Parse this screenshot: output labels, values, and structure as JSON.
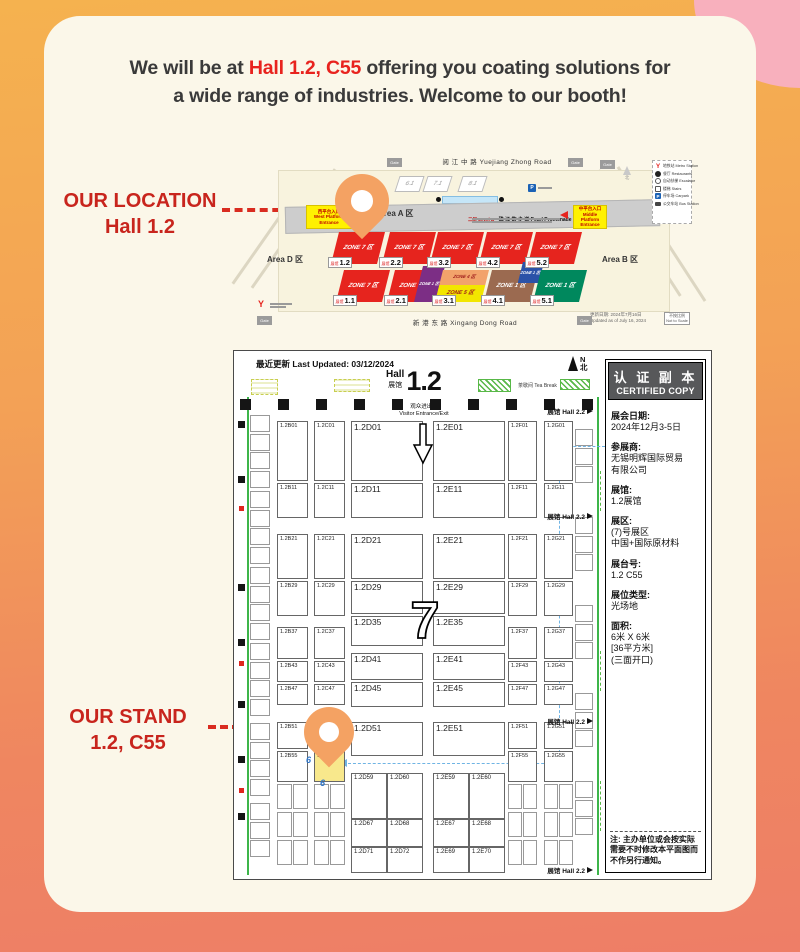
{
  "colors": {
    "accent_red": "#E8231E",
    "callout_red": "#C8251D",
    "pin_orange": "#F4A263",
    "stand_highlight": "#F8E88C",
    "zone7_red": "#E6241E"
  },
  "headline": {
    "line1_pre": "We will be at ",
    "line1_highlight": "Hall 1.2, C55",
    "line1_post": " offering you coating solutions for",
    "line2": "a wide range of industries. Welcome to our booth!"
  },
  "callouts": {
    "location_title": "OUR LOCATION",
    "location_value": "Hall 1.2",
    "stand_title": "OUR STAND",
    "stand_value": "1.2, C55"
  },
  "overview_map": {
    "roads": {
      "top": "阅 江 中 路  Yuejiang Zhong Road",
      "bottom": "新 港 东 路  Xingang Dong Road"
    },
    "gate_label": "Gate",
    "areas": {
      "a": "Area A 区",
      "b": "Area B 区",
      "d": "Area D 区"
    },
    "promenade": {
      "level": "二层 Level B",
      "name": "珠 江 散 步 道 Pearl Promenade"
    },
    "entrances": {
      "west": "西平台入口\nWest Platform\nEntrance",
      "middle": "中平台入口\nMiddle Platform\nEntrance"
    },
    "buildings": [
      "6.1",
      "7.1",
      "8.1"
    ],
    "north_label": "北",
    "parking_label": "P",
    "metro_label": "Y",
    "legend": [
      {
        "icon": "metro",
        "cn": "地铁站",
        "en": "Metro Station"
      },
      {
        "icon": "restaurant",
        "cn": "餐厅",
        "en": "Restaurants"
      },
      {
        "icon": "escalator",
        "cn": "自动扶梯",
        "en": "Escalator"
      },
      {
        "icon": "stairs",
        "cn": "楼梯",
        "en": "Stairs"
      },
      {
        "icon": "parking",
        "cn": "停车场",
        "en": "Carpark"
      },
      {
        "icon": "bus",
        "cn": "公交车站",
        "en": "Bus Station"
      }
    ],
    "update_note": "更新日期: 2024年7月16日\nUpdated as of July 16, 2024",
    "scale_note": "不按比例\nNot to Scale",
    "hall_chip_prefix": "展馆",
    "halls_row1": [
      {
        "id": "1.2",
        "parts": [
          {
            "pos": "full",
            "bg": "#E6241E",
            "tc": "#FFFFFF",
            "text": "ZONE 7 区"
          }
        ]
      },
      {
        "id": "2.2",
        "parts": [
          {
            "pos": "full",
            "bg": "#E6241E",
            "tc": "#FFFFFF",
            "text": "ZONE 7 区"
          }
        ]
      },
      {
        "id": "3.2",
        "parts": [
          {
            "pos": "full",
            "bg": "#E6241E",
            "tc": "#FFFFFF",
            "text": "ZONE 7 区"
          }
        ]
      },
      {
        "id": "4.2",
        "parts": [
          {
            "pos": "full",
            "bg": "#E6241E",
            "tc": "#FFFFFF",
            "text": "ZONE 7 区"
          }
        ]
      },
      {
        "id": "5.2",
        "parts": [
          {
            "pos": "full",
            "bg": "#E6241E",
            "tc": "#FFFFFF",
            "text": "ZONE 7 区"
          }
        ]
      }
    ],
    "halls_row2": [
      {
        "id": "1.1",
        "parts": [
          {
            "pos": "full",
            "bg": "#E6241E",
            "tc": "#FFFFFF",
            "text": "ZONE 7 区"
          }
        ]
      },
      {
        "id": "2.1",
        "parts": [
          {
            "pos": "full",
            "bg": "#E6241E",
            "tc": "#FFFFFF",
            "text": "ZONE 7 区"
          },
          {
            "pos": "right",
            "bg": "#7C2E85",
            "tc": "#FFFFFF",
            "text": "ZONE 1 区"
          }
        ]
      },
      {
        "id": "3.1",
        "parts": [
          {
            "pos": "top",
            "bg": "#F2A36B",
            "tc": "#9E1B1B",
            "text": "ZONE 4 区"
          },
          {
            "pos": "bottom",
            "bg": "#F2E600",
            "tc": "#9E1B1B",
            "text": "ZONE 5 区"
          }
        ]
      },
      {
        "id": "4.1",
        "parts": [
          {
            "pos": "full",
            "bg": "#9B6A50",
            "tc": "#FFFFFF",
            "text": "ZONE 1 区"
          },
          {
            "pos": "tr",
            "bg": "#2B52A8",
            "tc": "#FFFFFF",
            "text": "ZONE 1 区"
          }
        ]
      },
      {
        "id": "5.1",
        "parts": [
          {
            "pos": "full",
            "bg": "#00885D",
            "tc": "#FFFFFF",
            "text": "ZONE 1 区"
          }
        ]
      }
    ]
  },
  "floor_plan": {
    "last_updated": "最近更新 Last Updated: 03/12/2024",
    "title": {
      "en": "Hall",
      "cn": "展馆",
      "num": "1.2"
    },
    "compass": {
      "n": "N",
      "cn": "北"
    },
    "visitor_entrance": "观众进出口\nVisitor Entrance/Exit",
    "tea_break": "茶歇间 Tea Break",
    "hall22": "展馆 Hall 2.2",
    "zone_number": "7",
    "stand_number": "6",
    "booths": [
      {
        "i": "1.2B01",
        "x": 43,
        "y": 70,
        "w": 31,
        "h": 60,
        "f": 5.5
      },
      {
        "i": "1.2B11",
        "x": 43,
        "y": 132,
        "w": 31,
        "h": 35,
        "f": 5.5
      },
      {
        "i": "1.2B21",
        "x": 43,
        "y": 183,
        "w": 31,
        "h": 45,
        "f": 5.5
      },
      {
        "i": "1.2B29",
        "x": 43,
        "y": 230,
        "w": 31,
        "h": 35,
        "f": 5.5
      },
      {
        "i": "1.2B37",
        "x": 43,
        "y": 276,
        "w": 31,
        "h": 32,
        "f": 5.5
      },
      {
        "i": "1.2B43",
        "x": 43,
        "y": 310,
        "w": 31,
        "h": 21,
        "f": 5.5
      },
      {
        "i": "1.2B47",
        "x": 43,
        "y": 333,
        "w": 31,
        "h": 21,
        "f": 5.5
      },
      {
        "i": "1.2B51",
        "x": 43,
        "y": 371,
        "w": 31,
        "h": 27,
        "f": 5.5
      },
      {
        "i": "1.2B55",
        "x": 43,
        "y": 400,
        "w": 31,
        "h": 31,
        "f": 5.5
      },
      {
        "i": "1.2C01",
        "x": 80,
        "y": 70,
        "w": 31,
        "h": 60,
        "f": 5.5
      },
      {
        "i": "1.2C11",
        "x": 80,
        "y": 132,
        "w": 31,
        "h": 35,
        "f": 5.5
      },
      {
        "i": "1.2C21",
        "x": 80,
        "y": 183,
        "w": 31,
        "h": 45,
        "f": 5.5
      },
      {
        "i": "1.2C29",
        "x": 80,
        "y": 230,
        "w": 31,
        "h": 35,
        "f": 5.5
      },
      {
        "i": "1.2C37",
        "x": 80,
        "y": 276,
        "w": 31,
        "h": 32,
        "f": 5.5
      },
      {
        "i": "1.2C43",
        "x": 80,
        "y": 310,
        "w": 31,
        "h": 21,
        "f": 5.5
      },
      {
        "i": "1.2C47",
        "x": 80,
        "y": 333,
        "w": 31,
        "h": 21,
        "f": 5.5
      },
      {
        "i": "1.2C51",
        "x": 80,
        "y": 371,
        "w": 31,
        "h": 27,
        "f": 5.5
      },
      {
        "i": "1.2C55",
        "x": 80,
        "y": 400,
        "w": 31,
        "h": 31,
        "f": 5.5,
        "hl": 1
      },
      {
        "i": "1.2D01",
        "x": 117,
        "y": 70,
        "w": 72,
        "h": 60,
        "f": 8.5
      },
      {
        "i": "1.2D11",
        "x": 117,
        "y": 132,
        "w": 72,
        "h": 35,
        "f": 8.5
      },
      {
        "i": "1.2D21",
        "x": 117,
        "y": 183,
        "w": 72,
        "h": 45,
        "f": 8.5
      },
      {
        "i": "1.2D29",
        "x": 117,
        "y": 230,
        "w": 72,
        "h": 33,
        "f": 8.5
      },
      {
        "i": "1.2D35",
        "x": 117,
        "y": 265,
        "w": 72,
        "h": 30,
        "f": 8.5
      },
      {
        "i": "1.2D41",
        "x": 117,
        "y": 302,
        "w": 72,
        "h": 27,
        "f": 8.5
      },
      {
        "i": "1.2D45",
        "x": 117,
        "y": 331,
        "w": 72,
        "h": 25,
        "f": 8.5
      },
      {
        "i": "1.2D51",
        "x": 117,
        "y": 371,
        "w": 72,
        "h": 34,
        "f": 8.5
      },
      {
        "i": "1.2D59",
        "x": 117,
        "y": 422,
        "w": 36,
        "h": 46,
        "f": 6
      },
      {
        "i": "1.2D60",
        "x": 153,
        "y": 422,
        "w": 36,
        "h": 46,
        "f": 6
      },
      {
        "i": "1.2D67",
        "x": 117,
        "y": 468,
        "w": 36,
        "h": 28,
        "f": 6
      },
      {
        "i": "1.2D68",
        "x": 153,
        "y": 468,
        "w": 36,
        "h": 28,
        "f": 6
      },
      {
        "i": "1.2D71",
        "x": 117,
        "y": 496,
        "w": 36,
        "h": 26,
        "f": 6
      },
      {
        "i": "1.2D72",
        "x": 153,
        "y": 496,
        "w": 36,
        "h": 26,
        "f": 6
      },
      {
        "i": "1.2E01",
        "x": 199,
        "y": 70,
        "w": 72,
        "h": 60,
        "f": 8.5
      },
      {
        "i": "1.2E11",
        "x": 199,
        "y": 132,
        "w": 72,
        "h": 35,
        "f": 8.5
      },
      {
        "i": "1.2E21",
        "x": 199,
        "y": 183,
        "w": 72,
        "h": 45,
        "f": 8.5
      },
      {
        "i": "1.2E29",
        "x": 199,
        "y": 230,
        "w": 72,
        "h": 33,
        "f": 8.5
      },
      {
        "i": "1.2E35",
        "x": 199,
        "y": 265,
        "w": 72,
        "h": 30,
        "f": 8.5
      },
      {
        "i": "1.2E41",
        "x": 199,
        "y": 302,
        "w": 72,
        "h": 27,
        "f": 8.5
      },
      {
        "i": "1.2E45",
        "x": 199,
        "y": 331,
        "w": 72,
        "h": 25,
        "f": 8.5
      },
      {
        "i": "1.2E51",
        "x": 199,
        "y": 371,
        "w": 72,
        "h": 34,
        "f": 8.5
      },
      {
        "i": "1.2E59",
        "x": 199,
        "y": 422,
        "w": 36,
        "h": 46,
        "f": 6
      },
      {
        "i": "1.2E60",
        "x": 235,
        "y": 422,
        "w": 36,
        "h": 46,
        "f": 6
      },
      {
        "i": "1.2E67",
        "x": 199,
        "y": 468,
        "w": 36,
        "h": 28,
        "f": 6
      },
      {
        "i": "1.2E68",
        "x": 235,
        "y": 468,
        "w": 36,
        "h": 28,
        "f": 6
      },
      {
        "i": "1.2E69",
        "x": 199,
        "y": 496,
        "w": 36,
        "h": 26,
        "f": 6
      },
      {
        "i": "1.2E70",
        "x": 235,
        "y": 496,
        "w": 36,
        "h": 26,
        "f": 6
      },
      {
        "i": "1.2F01",
        "x": 274,
        "y": 70,
        "w": 29,
        "h": 60,
        "f": 5.5
      },
      {
        "i": "1.2F11",
        "x": 274,
        "y": 132,
        "w": 29,
        "h": 35,
        "f": 5.5
      },
      {
        "i": "1.2F21",
        "x": 274,
        "y": 183,
        "w": 29,
        "h": 45,
        "f": 5.5
      },
      {
        "i": "1.2F29",
        "x": 274,
        "y": 230,
        "w": 29,
        "h": 35,
        "f": 5.5
      },
      {
        "i": "1.2F37",
        "x": 274,
        "y": 276,
        "w": 29,
        "h": 32,
        "f": 5.5
      },
      {
        "i": "1.2F43",
        "x": 274,
        "y": 310,
        "w": 29,
        "h": 21,
        "f": 5.5
      },
      {
        "i": "1.2F47",
        "x": 274,
        "y": 333,
        "w": 29,
        "h": 21,
        "f": 5.5
      },
      {
        "i": "1.2F51",
        "x": 274,
        "y": 371,
        "w": 29,
        "h": 27,
        "f": 5.5
      },
      {
        "i": "1.2F55",
        "x": 274,
        "y": 400,
        "w": 29,
        "h": 31,
        "f": 5.5
      },
      {
        "i": "1.2G01",
        "x": 310,
        "y": 70,
        "w": 29,
        "h": 60,
        "f": 5.5
      },
      {
        "i": "1.2G11",
        "x": 310,
        "y": 132,
        "w": 29,
        "h": 35,
        "f": 5.5
      },
      {
        "i": "1.2G21",
        "x": 310,
        "y": 183,
        "w": 29,
        "h": 45,
        "f": 5.5
      },
      {
        "i": "1.2G29",
        "x": 310,
        "y": 230,
        "w": 29,
        "h": 35,
        "f": 5.5
      },
      {
        "i": "1.2G37",
        "x": 310,
        "y": 276,
        "w": 29,
        "h": 32,
        "f": 5.5
      },
      {
        "i": "1.2G43",
        "x": 310,
        "y": 310,
        "w": 29,
        "h": 21,
        "f": 5.5
      },
      {
        "i": "1.2G47",
        "x": 310,
        "y": 333,
        "w": 29,
        "h": 21,
        "f": 5.5
      },
      {
        "i": "1.2G51",
        "x": 310,
        "y": 371,
        "w": 29,
        "h": 27,
        "f": 5.5
      },
      {
        "i": "1.2G55",
        "x": 310,
        "y": 400,
        "w": 29,
        "h": 31,
        "f": 5.5
      }
    ]
  },
  "sidebar": {
    "title_cn": "认 证 副 本",
    "title_en": "CERTIFIED COPY",
    "fields": [
      {
        "label": "展会日期:",
        "value": "2024年12月3-5日"
      },
      {
        "label": "参展商:",
        "value": "无锡明辉国际贸易\n有限公司"
      },
      {
        "label": "展馆:",
        "value": "1.2展馆"
      },
      {
        "label": "展区:",
        "value": "(7)号展区\n中国+国际原材料"
      },
      {
        "label": "展台号:",
        "value": "1.2 C55"
      },
      {
        "label": "展位类型:",
        "value": "光场地"
      },
      {
        "label": "面积:",
        "value": "6米 X 6米\n[36平方米]\n(三面开口)"
      }
    ],
    "note": "注: 主办单位或会按实际\n需要不时修改本平面图而\n不作另行通知。"
  }
}
